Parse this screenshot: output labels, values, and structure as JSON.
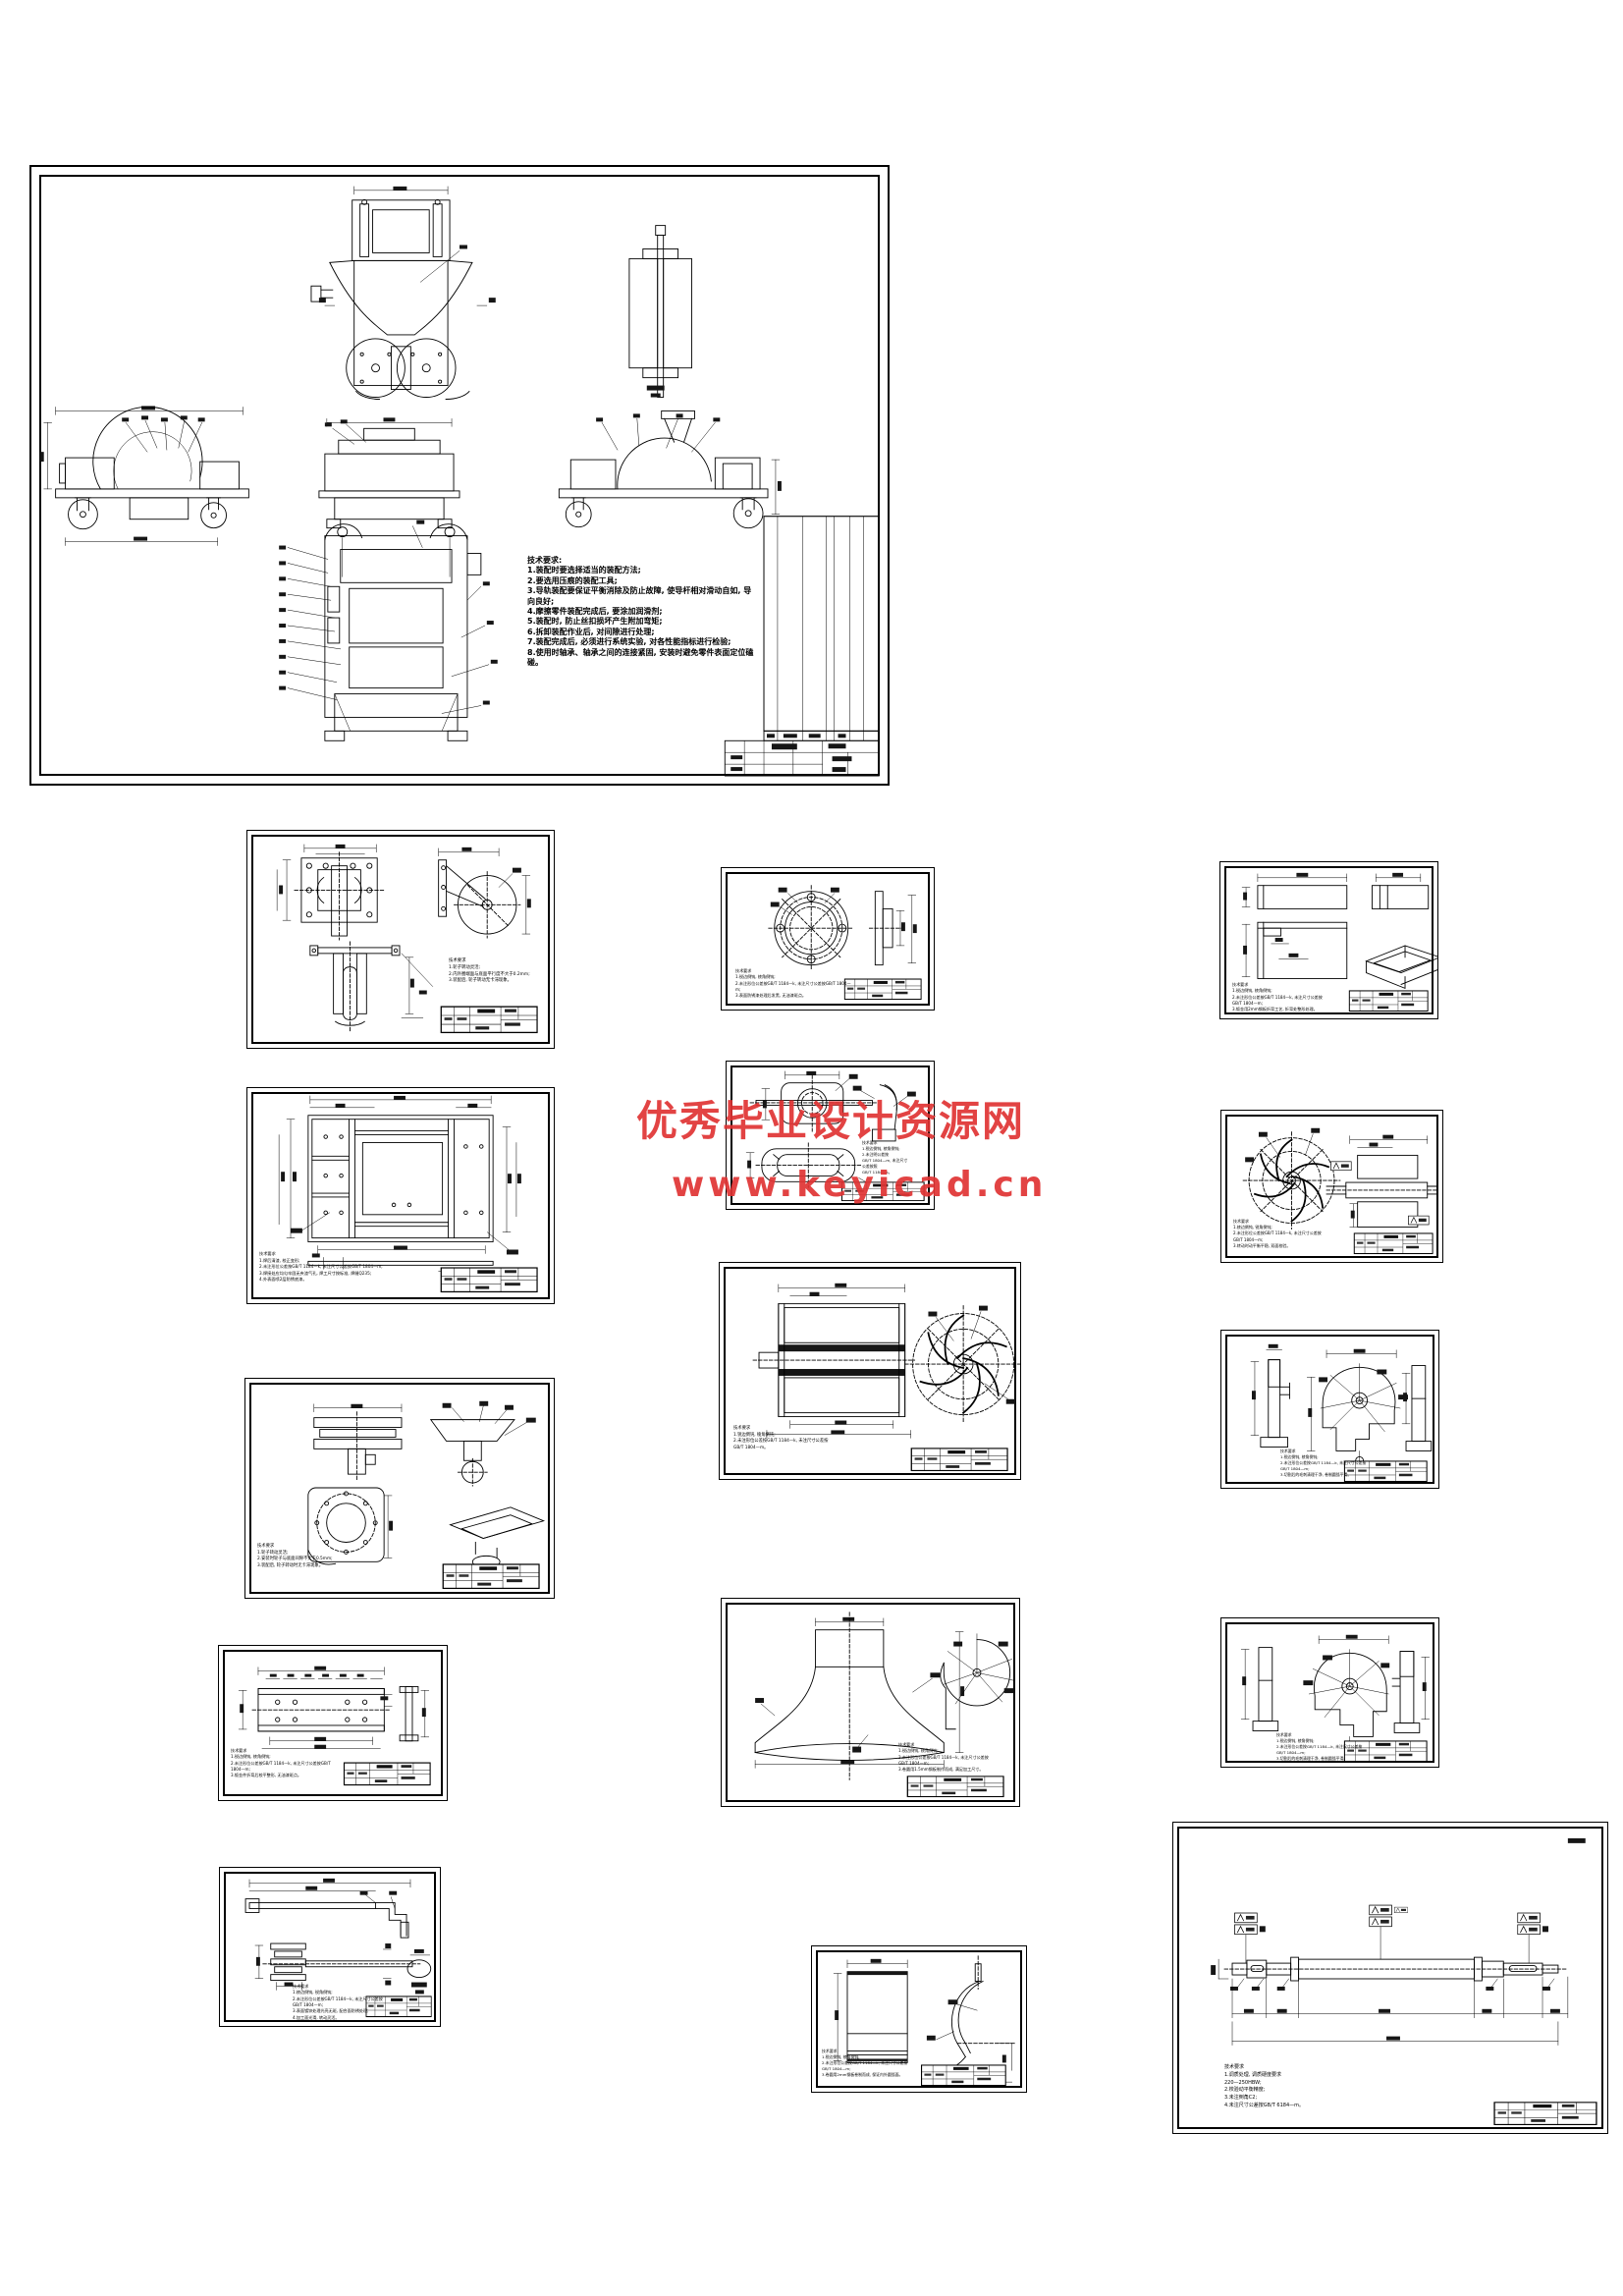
{
  "watermark": {
    "line1": "优秀毕业设计资源网",
    "line2": "www.keyicad.cn",
    "color": "#e03434"
  },
  "main": {
    "notes": "技术要求:\n1.装配时要选择适当的装配方法;\n2.要选用压痕的装配工具;\n3.导轨装配要保证平衡消除及防止故障, 使导杆相对滑动自如, 导向良好;\n4.摩擦零件装配完成后, 要涂加润滑剂;\n5.装配时, 防止丝扣损坏产生附加弯矩;\n6.拆卸装配作业后, 对间隙进行处理;\n7.装配完成后, 必须进行系统实验, 对各性能指标进行检验;\n8.使用时轴承、轴承之间的连接紧固, 安装时避免零件表面定位磕碰。"
  },
  "sheets": {
    "caster": {
      "notes": "技术要求\n1.轮子转动灵活;\n2.内外圈端面与底面平行度不大于0.2mm;\n3.装配后, 轮子转动无卡滞现象。"
    },
    "frame": {
      "notes": "技术要求\n1.焊后清渣, 校正变形;\n2.未注形位公差按GB/T 1184—k, 未注尺寸公差按GB/T 1804—m;\n3.焊接处应均匀牢固无夹渣气孔, 焊工尺寸按标准, 焊缝Q235;\n4.外表面喷2层防锈底漆。"
    },
    "pulley": {
      "notes": "技术要求\n1.轮子转动灵活;\n2.安装时轮子与底面间隙不大于0.5mm;\n3.装配后, 轮子转动时无卡滞现象。"
    },
    "plate": {
      "notes": "技术要求\n1.锐边倒钝, 棱角倒钝;\n2.未注形位公差按GB/T 1184—k, 未注尺寸公差按GB/T 1804—m;\n3.钣金件折弯后校平整形, 无油漆斑点。"
    },
    "lever": {
      "notes": "技术要求\n1.棱边倒钝, 锐角倒钝;\n2.未注形位公差按GB/T 1184—k, 未注尺寸公差按\nGB/T 1804—m;\n3.表面镀锌处理光亮无斑, 配合面防锈处理;\n4.加工面光滑, 转动灵活。"
    },
    "flange": {
      "notes": "技术要求\n1.锐边倒钝, 棱角倒钝;\n2.未注形位公差按GB/T 1184—k, 未注尺寸公差按GB/T 1804—m;\n3.表面防锈漆处理后发黑, 无油漆斑点。"
    },
    "bracket": {
      "notes": "技术要求\n1.锐边倒钝, 棱角倒钝;\n2.未注明公差按\nGB/T 1804—m, 未注尺寸\n公差按照\nGB/T 1184—k。"
    },
    "impeller": {
      "notes": "技术要求\n1.锐边倒钝, 棱角倒钝;\n2.未注形位公差按GB/T 1184—k, 未注尺寸公差按\nGB/T 1804—m。"
    },
    "funnel": {
      "notes": "技术要求\n1.锐边倒钝, 棱角倒钝;\n2.未注形位公差按GB/T 1184—k, 未注尺寸公差按\nGB/T 1804—m;\n3.卷圆用1.5mm钢板制作而成, 满足加工尺寸。"
    },
    "curved": {
      "notes": "技术要求\n1.锐边倒钝, 棱角倒钝;\n2.未注形位公差按GB/T 1184—k, 未注尺寸公差按\nGB/T 1804—m;\n3.卷圆用2mm钢板卷制而成, 保证内外圆弧面。"
    },
    "tray": {
      "notes": "技术要求\n1.锐边倒钝, 棱角倒钝;\n2.未注形位公差按GB/T 1184—k, 未注尺寸公差按\nGB/T 1804—m;\n3.钣金用2mm钢板折弯工艺, 折弯处整形处理。"
    },
    "rotor": {
      "notes": "技术要求\n1.棱边倒钝, 锐角倒钝;\n2.未注形位公差按GB/T 1184—k, 未注尺寸公差按\nGB/T 1804—m;\n3.转动时动平衡平稳, 双面校验。"
    },
    "volute1": {
      "notes": "技术要求\n1.锐边倒钝, 棱角倒钝;\n2.未注形位公差按GB/T 1184—k, 未注尺寸公差按\nGB/T 1804—m;\n3.切割后的毛刺清理干净, 卷制圆弧平滑。"
    },
    "volute2": {
      "notes": "技术要求\n1.锐边倒钝, 棱角倒钝;\n2.未注形位公差按GB/T 1184—k, 未注尺寸公差按\nGB/T 1804—m;\n3.切割后的毛刺清理干净, 卷制圆弧平滑。"
    },
    "shaft": {
      "notes": "技术要求\n1.调质处理, 调质硬度要求\n220—250HBW;\n2.校验动平衡精度;\n3.未注倒角C2;\n4.未注尺寸公差按GB/T 6184—m。"
    }
  }
}
